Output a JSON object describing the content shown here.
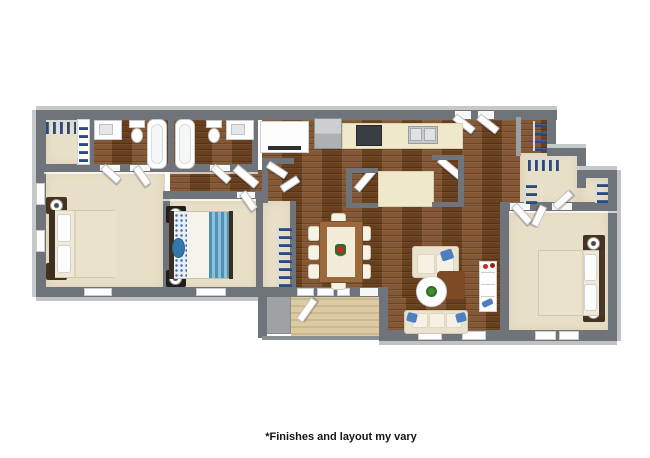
{
  "image_type": "3d-floor-plan-rendering",
  "footer": {
    "note": "*Finishes and layout my vary"
  },
  "palette": {
    "wall_gray": "#6f747a",
    "wall_bevel_light": "#c6c9cc",
    "wood_floor_brown": "#7a4a23",
    "carpet_beige": "#e8dfc8",
    "deck_tan": "#dccaa3",
    "patio_gray": "#9fa2a5",
    "counter_cream": "#efe8cb",
    "fixture_white": "#ffffff",
    "appliance_steel": "#b9bcbf",
    "stove_black": "#3a3e42",
    "bedding_teal_blue": "#4e93b5",
    "pillow_blue": "#4d7ec0",
    "hanging_clothes_navy": "#2b4a7d",
    "plant_green": "#3f8d2e",
    "flower_red": "#c62828",
    "nightstand_brown": "#46331f"
  },
  "rooms": [
    "walk-in-closet-top-left",
    "bathroom-1",
    "bathroom-2",
    "bedroom-1",
    "bedroom-2",
    "hallway",
    "kitchen",
    "living-dining-area",
    "entry",
    "walk-in-closet-right",
    "bedroom-3",
    "balcony-deck",
    "patio"
  ],
  "furniture": [
    "double-bed-x3",
    "nightstands-with-lamps",
    "bathtub-x2",
    "toilet-x2",
    "vanity-sink-x2",
    "refrigerator",
    "range-stove",
    "double-sink",
    "kitchen-counter",
    "island-counter",
    "dining-table-8-chairs",
    "loveseat",
    "sofa",
    "round-coffee-table-with-plant",
    "bookshelf",
    "hanging-clothes-rails",
    "white-cabinet"
  ]
}
